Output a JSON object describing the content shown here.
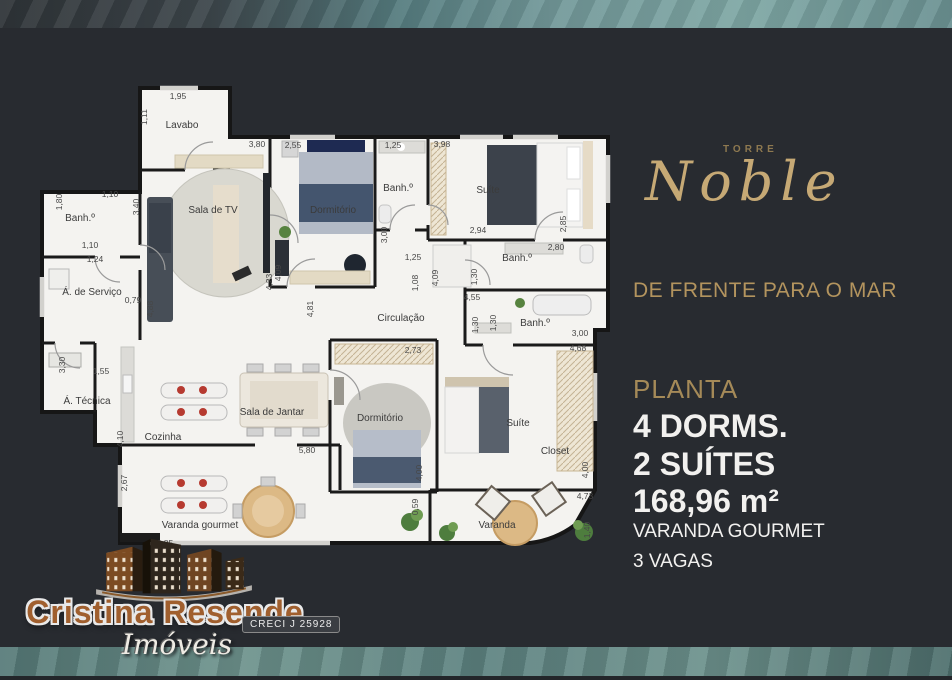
{
  "panel": {
    "torre": "TORRE",
    "name": "Noble",
    "tagline": "DE FRENTE PARA O MAR",
    "planta": "PLANTA",
    "dorms": "4 DORMS.",
    "suites": "2 SUÍTES",
    "area": "168,96 m²",
    "varanda_gourmet": "VARANDA GOURMET",
    "vagas": "3 VAGAS"
  },
  "logo": {
    "name": "Cristina Resende",
    "sub": "Imóveis",
    "creci": "CRECI J 25928"
  },
  "plan": {
    "rooms": {
      "lavabo": "Lavabo",
      "sala_tv": "Sala de TV",
      "dorm1": "Dormitório",
      "banh1": "Banh.º",
      "suite1": "Suíte",
      "banh_s1": "Banh.º",
      "banh_tl": "Banh.º",
      "servico": "Á. de Serviço",
      "tecnica": "Á. Técnica",
      "cozinha": "Cozinha",
      "jantar": "Sala de Jantar",
      "circulacao": "Circulação",
      "dorm2": "Dormitório",
      "banh2": "Banh.º",
      "suite2": "Suíte",
      "closet": "Closet",
      "vgourmet": "Varanda gourmet",
      "varanda": "Varanda"
    },
    "dims": {
      "d195": "1,95",
      "d111": "1,11",
      "d380": "3,80",
      "d255": "2,55",
      "d125a": "1,25",
      "d398": "3,98",
      "d110a": "1,10",
      "d180": "1,80",
      "d340": "3,40",
      "d110b": "1,10",
      "d124": "1,24",
      "d079": "0,79",
      "d488": "4,88",
      "d300a": "3,00",
      "d125b": "1,25",
      "d108": "1,08",
      "d409a": "4,09",
      "d409b": "4,09",
      "d423": "4,23",
      "d481": "4,81",
      "d294": "2,94",
      "d285": "2,85",
      "d280": "2,80",
      "d130a": "1,30",
      "d455": "4,55",
      "d130b": "1,30",
      "d130c": "1,30",
      "d300b": "3,00",
      "d468": "4,68",
      "d273": "2,73",
      "d410": "4,10",
      "d267": "2,67",
      "d155": "1,55",
      "d330": "3,30",
      "d580": "5,80",
      "d400a": "4,00",
      "d059": "0,59",
      "d400b": "4,00",
      "d473": "4,73",
      "d140": "1,40",
      "d385": "3,85"
    }
  },
  "colors": {
    "background": "#282b30",
    "marble_teal": "#6f9697",
    "accent_gold": "#c6a975",
    "panel_text": "#f2f1ef",
    "logo_bronze": "#a05f2e",
    "plan_wall": "#161616",
    "plan_floor": "#f4f3f0",
    "hatch_beige": "#eee6d4",
    "burner_red": "#b63a30",
    "table_tan": "#dcb985",
    "plant_green": "#4e7d3e"
  }
}
